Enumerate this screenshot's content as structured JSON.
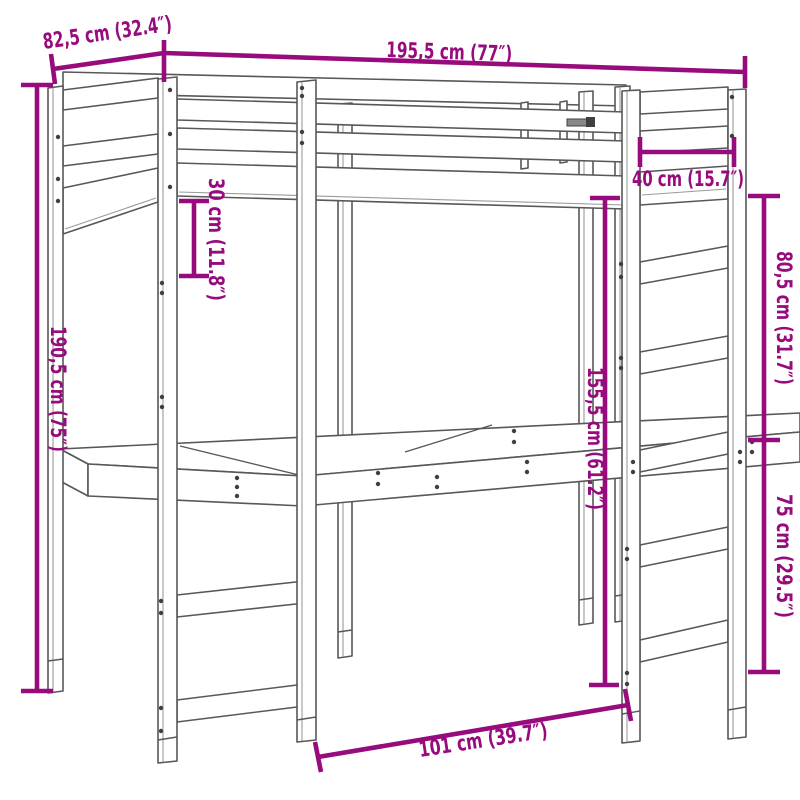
{
  "figure": {
    "kind": "product dimension diagram",
    "subject": "loft bed with desk and ladder",
    "background_color": "#ffffff",
    "drawing_line_color": "#58585a",
    "dimension_color": "#970B7D"
  },
  "dimensions": [
    {
      "id": "bed-depth-top-left",
      "cm": "82,5",
      "inches": "32.4",
      "label": "82,5 cm (32.4″)"
    },
    {
      "id": "bed-length-top",
      "cm": "195,5",
      "inches": "77",
      "label": "195,5 cm (77″)"
    },
    {
      "id": "overall-height-left",
      "cm": "190,5",
      "inches": "75",
      "label": "190,5 cm (75″)"
    },
    {
      "id": "guard-rail-height",
      "cm": "30",
      "inches": "11.8",
      "label": "30 cm (11.8″)"
    },
    {
      "id": "ladder-width",
      "cm": "40",
      "inches": "15.7",
      "label": "40 cm (15.7″)"
    },
    {
      "id": "upper-section-height",
      "cm": "80,5",
      "inches": "31.7",
      "label": "80,5 cm (31.7″)"
    },
    {
      "id": "under-bed-clearance",
      "cm": "155,5",
      "inches": "61.2",
      "label": "155,5 cm (61.2″)"
    },
    {
      "id": "desk-level-height",
      "cm": "75",
      "inches": "29.5",
      "label": "75 cm (29.5″)"
    },
    {
      "id": "desk-opening-width",
      "cm": "101",
      "inches": "39.7",
      "label": "101 cm (39.7″)"
    }
  ]
}
